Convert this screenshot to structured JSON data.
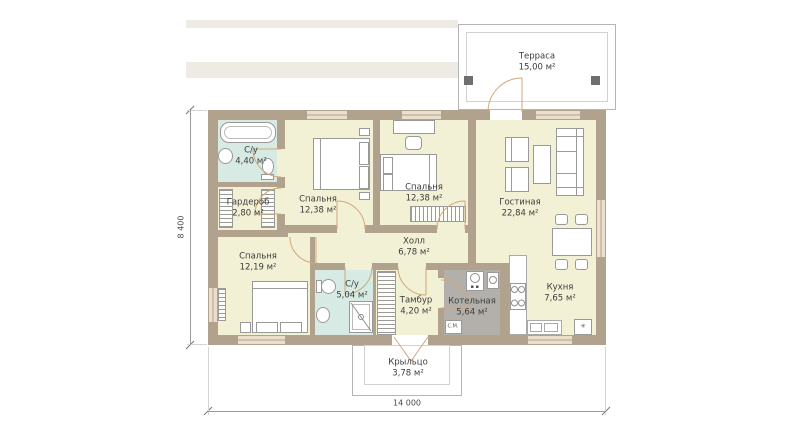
{
  "plan": {
    "rooms": [
      {
        "name": "Терраса",
        "area": "15,00 м²"
      },
      {
        "name": "С/у",
        "area": "4,40 м²"
      },
      {
        "name": "Гардероб",
        "area": "2,80 м²"
      },
      {
        "name": "Спальня",
        "area": "12,38 м²"
      },
      {
        "name": "Спальня",
        "area": "12,38 м²"
      },
      {
        "name": "Гостиная",
        "area": "22,84 м²"
      },
      {
        "name": "Холл",
        "area": "6,78 м²"
      },
      {
        "name": "Спальня",
        "area": "12,19 м²"
      },
      {
        "name": "С/у",
        "area": "5,04 м²"
      },
      {
        "name": "Тамбур",
        "area": "4,20 м²"
      },
      {
        "name": "Котельная",
        "area": "5,64 м²"
      },
      {
        "name": "Кухня",
        "area": "7,65 м²"
      },
      {
        "name": "Крыльцо",
        "area": "3,78 м²"
      }
    ],
    "dimensions": {
      "width": "14 000",
      "height": "8 400"
    },
    "appliances": {
      "washer": "С.М.",
      "fridge_symbol": "✳"
    },
    "colors": {
      "wall": "#b1a28d",
      "floor": "#f2f1d6",
      "wet_room": "#d7ebe4",
      "boiler_floor": "#b3b0ab",
      "door_arc": "#cfa878",
      "window_fill": "#e9dfca",
      "dimension_line": "#9b9b9b",
      "label_text": "#3c3c3c"
    }
  }
}
